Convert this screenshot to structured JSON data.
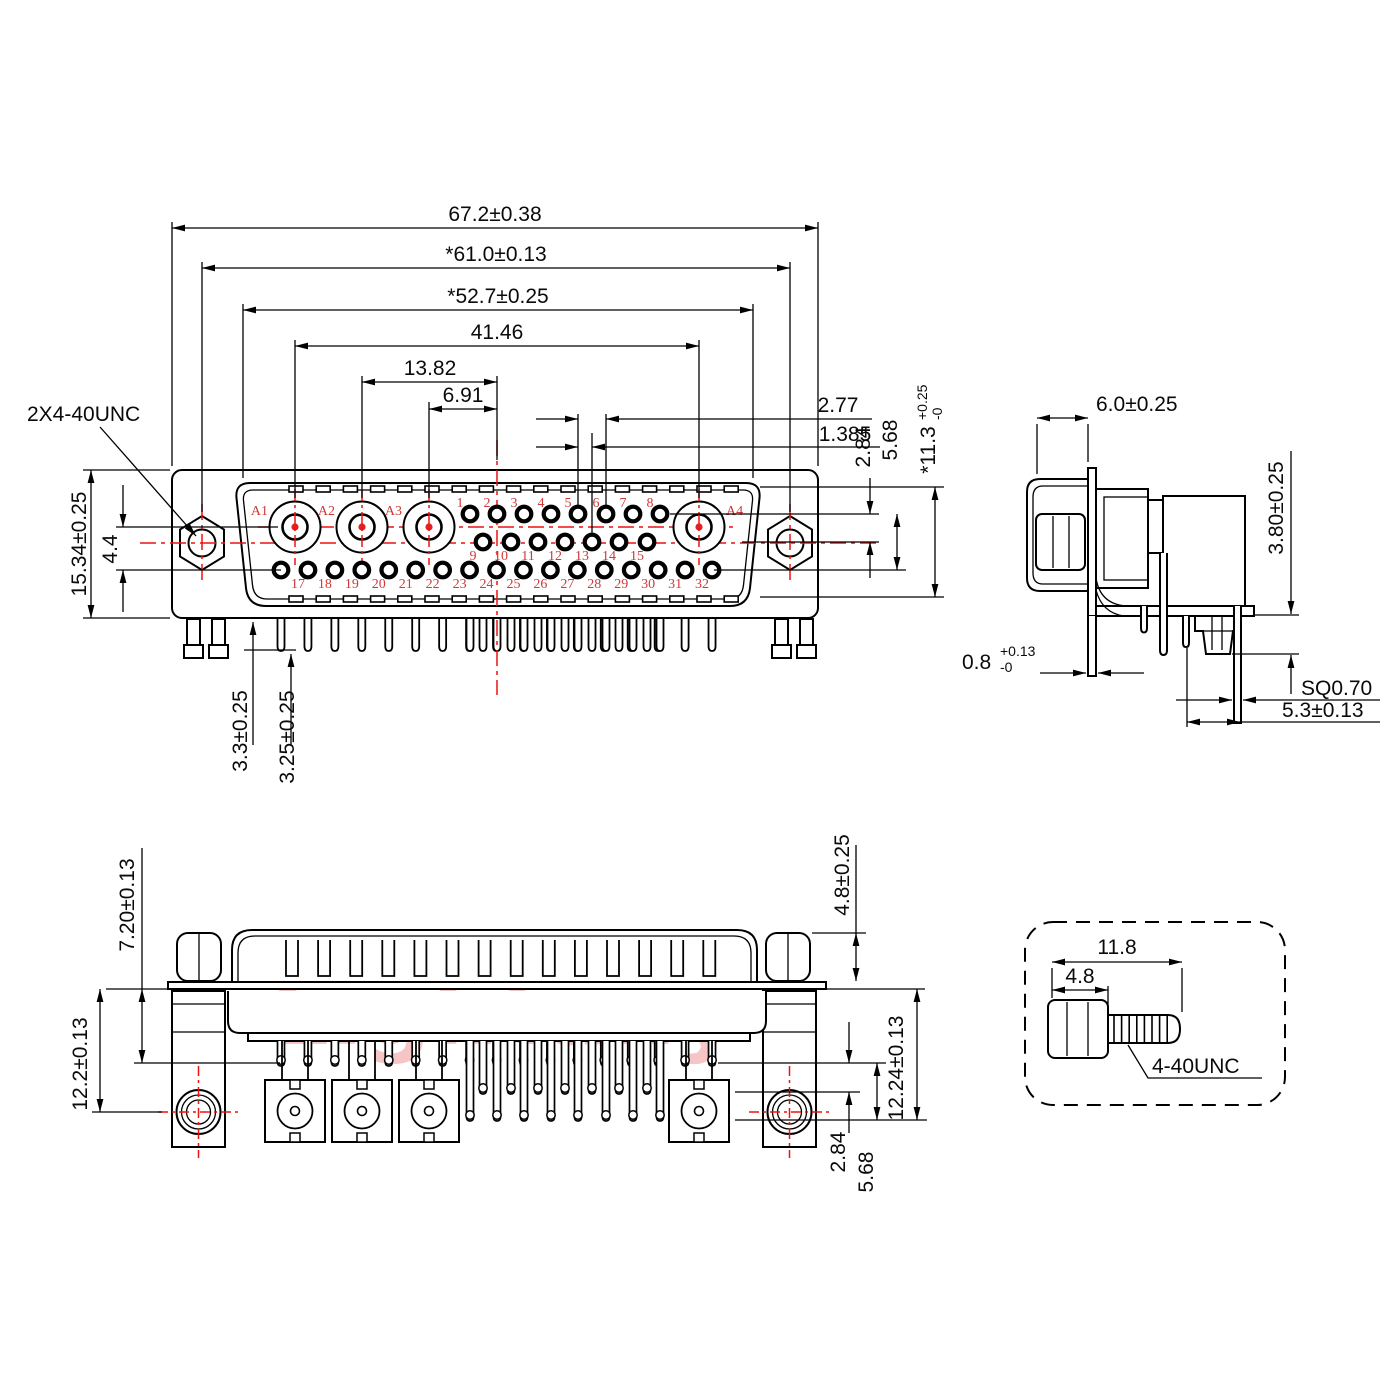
{
  "watermark": {
    "text": "Lightany"
  },
  "colors": {
    "line": "#000000",
    "accent_red": "#ef1010",
    "pin_label_red": "#cd3a3a",
    "watermark_pink": "#f6c5c5"
  },
  "front_view": {
    "thread_label": "2X4-40UNC",
    "coax_labels": [
      "A1",
      "A2",
      "A3",
      "A4"
    ],
    "pin_rows": {
      "top": [
        "1",
        "2",
        "3",
        "4",
        "5",
        "6",
        "7",
        "8"
      ],
      "middle": [
        "9",
        "10",
        "11",
        "12",
        "13",
        "14",
        "15"
      ],
      "bottom": [
        "",
        "17",
        "18",
        "19",
        "20",
        "21",
        "22",
        "23",
        "24",
        "25",
        "26",
        "27",
        "28",
        "29",
        "30",
        "31",
        "32"
      ]
    },
    "dims": {
      "width_flange": "67.2±0.38",
      "width_mount": "*61.0±0.13",
      "width_shell": "*52.7±0.25",
      "coax_span": "41.46",
      "coax_pitch2": "13.82",
      "coax_pitch1": "6.91",
      "pin_pitch": "2.77",
      "pin_half_pitch": "1.385",
      "row_offset": "2.84",
      "row_span": "5.68",
      "shell_height": {
        "main": "*11.3",
        "plus": "+0.25",
        "minus": "-0"
      },
      "flange_height": "15.34±0.25",
      "coax_to_row": "4.4",
      "tail_a": "3.3±0.25",
      "tail_b": "3.25±0.25"
    }
  },
  "side_view": {
    "dims": {
      "depth": "6.0±0.25",
      "standoff": "3.80±0.25",
      "plate_thickness": {
        "main": "0.8",
        "plus": "+0.13",
        "minus": "-0"
      },
      "pin_square": "SQ0.70",
      "pin_offset": "5.3±0.13"
    }
  },
  "bottom_view": {
    "dims": {
      "nut_to_face": "7.20±0.13",
      "hole_offset": "12.2±0.13",
      "nut_height": "4.8±0.25",
      "pin_depth": "12.24±0.13",
      "row_offset": "2.84",
      "row_span": "5.68"
    }
  },
  "screw_detail": {
    "dims": {
      "total_length": "11.8",
      "head_length": "4.8"
    },
    "thread_label": "4-40UNC"
  }
}
